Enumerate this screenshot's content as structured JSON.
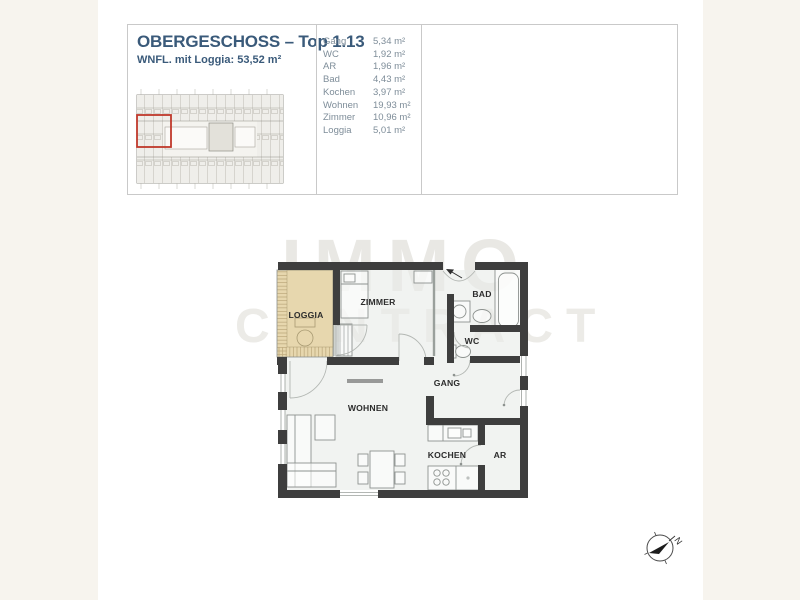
{
  "window": {
    "background": "#f7f4ee",
    "paper": "#ffffff"
  },
  "header": {
    "title": "OBERGESCHOSS – Top 1.13",
    "subtitle": "WNFL. mit Loggia: 53,52 m²"
  },
  "area_table": {
    "rows": [
      {
        "label": "Gang",
        "value": "5,34 m²"
      },
      {
        "label": "WC",
        "value": "1,92 m²"
      },
      {
        "label": "AR",
        "value": "1,96 m²"
      },
      {
        "label": "Bad",
        "value": "4,43 m²"
      },
      {
        "label": "Kochen",
        "value": "3,97 m²"
      },
      {
        "label": "Wohnen",
        "value": "19,93 m²"
      },
      {
        "label": "Zimmer",
        "value": "10,96 m²"
      },
      {
        "label": "Loggia",
        "value": "5,01 m²"
      }
    ]
  },
  "floorplan": {
    "labels": {
      "loggia": "LOGGIA",
      "zimmer": "ZIMMER",
      "bad": "BAD",
      "wc": "WC",
      "gang": "GANG",
      "wohnen": "WOHNEN",
      "kochen": "KOCHEN",
      "ar": "AR"
    },
    "colors": {
      "wall": "#3e3e3e",
      "room_fill": "#e9ece8",
      "loggia_fill": "#e7d7ae",
      "highlight_red": "#c0392b",
      "title_blue": "#3a5a7a",
      "table_text": "#7e8d99"
    }
  },
  "watermark": {
    "line1": "IMMO",
    "line2": "CONTRACT"
  },
  "compass": {
    "north_label": "N"
  }
}
